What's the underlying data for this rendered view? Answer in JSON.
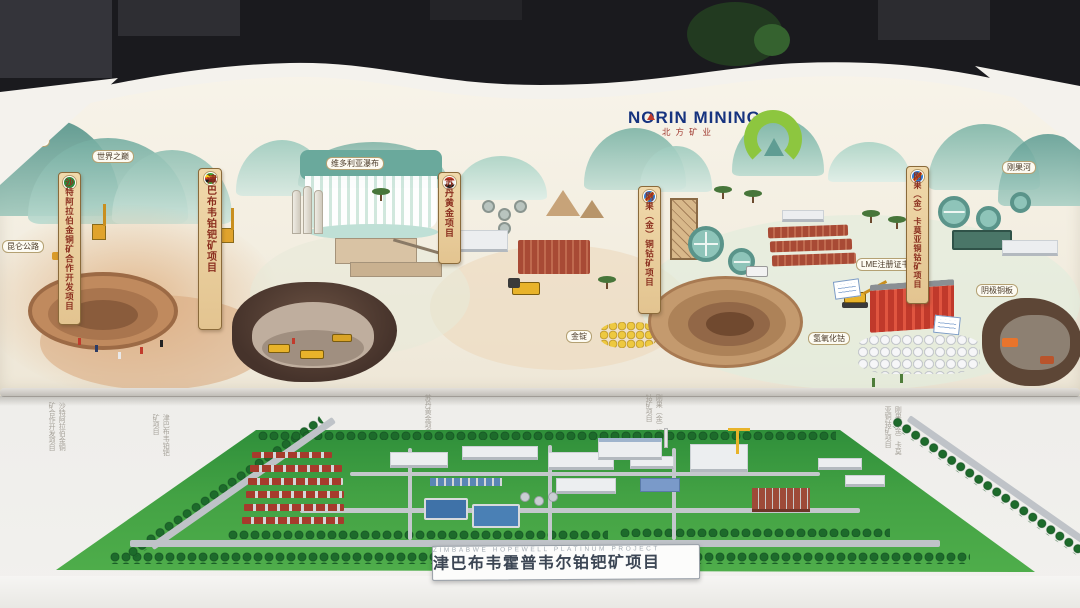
{
  "header": {
    "brand": "NORIN MINING",
    "brand_cn": "北方矿业"
  },
  "mural": {
    "landmarks": [
      {
        "text": "乔戈里峰"
      },
      {
        "text": "世界之巅"
      },
      {
        "text": "昆仑公路"
      },
      {
        "text": "维多利亚瀑布"
      },
      {
        "text": "刚果河"
      }
    ],
    "banners": [
      {
        "flag": "saudi-arabia-flag",
        "text": "沙特阿拉伯金铜矿合作开发项目"
      },
      {
        "flag": "zimbabwe-flag",
        "text": "津巴布韦铂钯矿项目"
      },
      {
        "flag": "sudan-flag",
        "text": "苏丹黄金项目"
      },
      {
        "flag": "dr-congo-flag",
        "text": "刚果（金）铜钴矿项目"
      },
      {
        "flag": "dr-congo-flag",
        "text": "刚果（金）卡莫亚铜钴矿项目"
      }
    ],
    "tags": [
      {
        "text": "金锭"
      },
      {
        "text": "LME注册证书"
      },
      {
        "text": "阴极铜板"
      },
      {
        "text": "氢氧化钴"
      }
    ]
  },
  "wall_captions": [
    "沙特阿拉伯金铜矿合作开发项目",
    "津巴布韦铂钯矿项目",
    "苏丹黄金项目",
    "刚果（金）铜钴矿项目",
    "刚果（金）卡莫亚铜钴矿项目"
  ],
  "model": {
    "plaque_title": "津巴布韦霍普韦尔铂钯矿项目",
    "plaque_subtitle": "ZIMBABWE HOPEWELL PLATINUM PROJECT"
  },
  "colors": {
    "accent_green": "#8dc63f",
    "brand_blue": "#16337f",
    "banner_text": "#8b2f1f",
    "model_green": "#3f9e3d"
  }
}
